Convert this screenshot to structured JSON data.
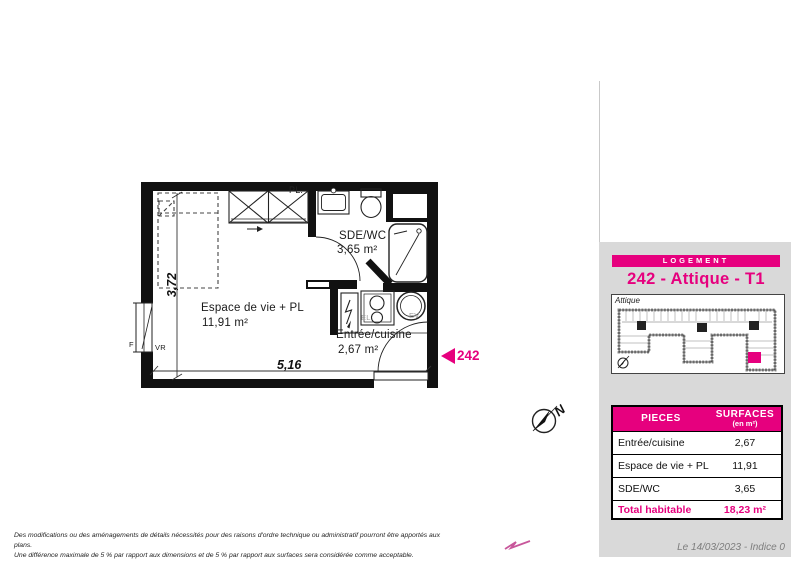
{
  "colors": {
    "accent": "#e6007e",
    "panel_gray": "#d9d9d9"
  },
  "plan": {
    "closet_label": "PL.",
    "rooms": [
      {
        "name": "Espace de vie + PL",
        "area": "11,91 m²"
      },
      {
        "name": "SDE/WC",
        "area": "3,65 m²"
      },
      {
        "name": "Entrée/cuisine",
        "area": "2,67 m²"
      }
    ],
    "dim_width": "5,16",
    "dim_height": "3,72",
    "window_label": "F",
    "shutter_label": "VR",
    "elec_label": "EL",
    "sink_label": "EV",
    "unit_number": "242",
    "north_letter": "N"
  },
  "panel": {
    "header": "LOGEMENT",
    "title": "242 - Attique - T1",
    "keyplan": {
      "floor_label": "Attique"
    },
    "table": {
      "col_pieces": "PIECES",
      "col_surfaces": "SURFACES",
      "col_surfaces_unit": "(en m²)",
      "rows": [
        {
          "name": "Entrée/cuisine",
          "value": "2,67"
        },
        {
          "name": "Espace de vie + PL",
          "value": "11,91"
        },
        {
          "name": "SDE/WC",
          "value": "3,65"
        }
      ],
      "total_label": "Total habitable",
      "total_value": "18,23 m²"
    }
  },
  "footer": {
    "disclaimer_line1": "Des modifications ou des aménagements de détails nécessités pour des raisons d'ordre technique ou administratif pourront être apportés aux plans.",
    "disclaimer_line2": "Une différence maximale de 5 % par rapport aux dimensions et de 5 % par rapport aux surfaces sera considérée comme acceptable.",
    "date": "Le 14/03/2023 - Indice 0"
  }
}
